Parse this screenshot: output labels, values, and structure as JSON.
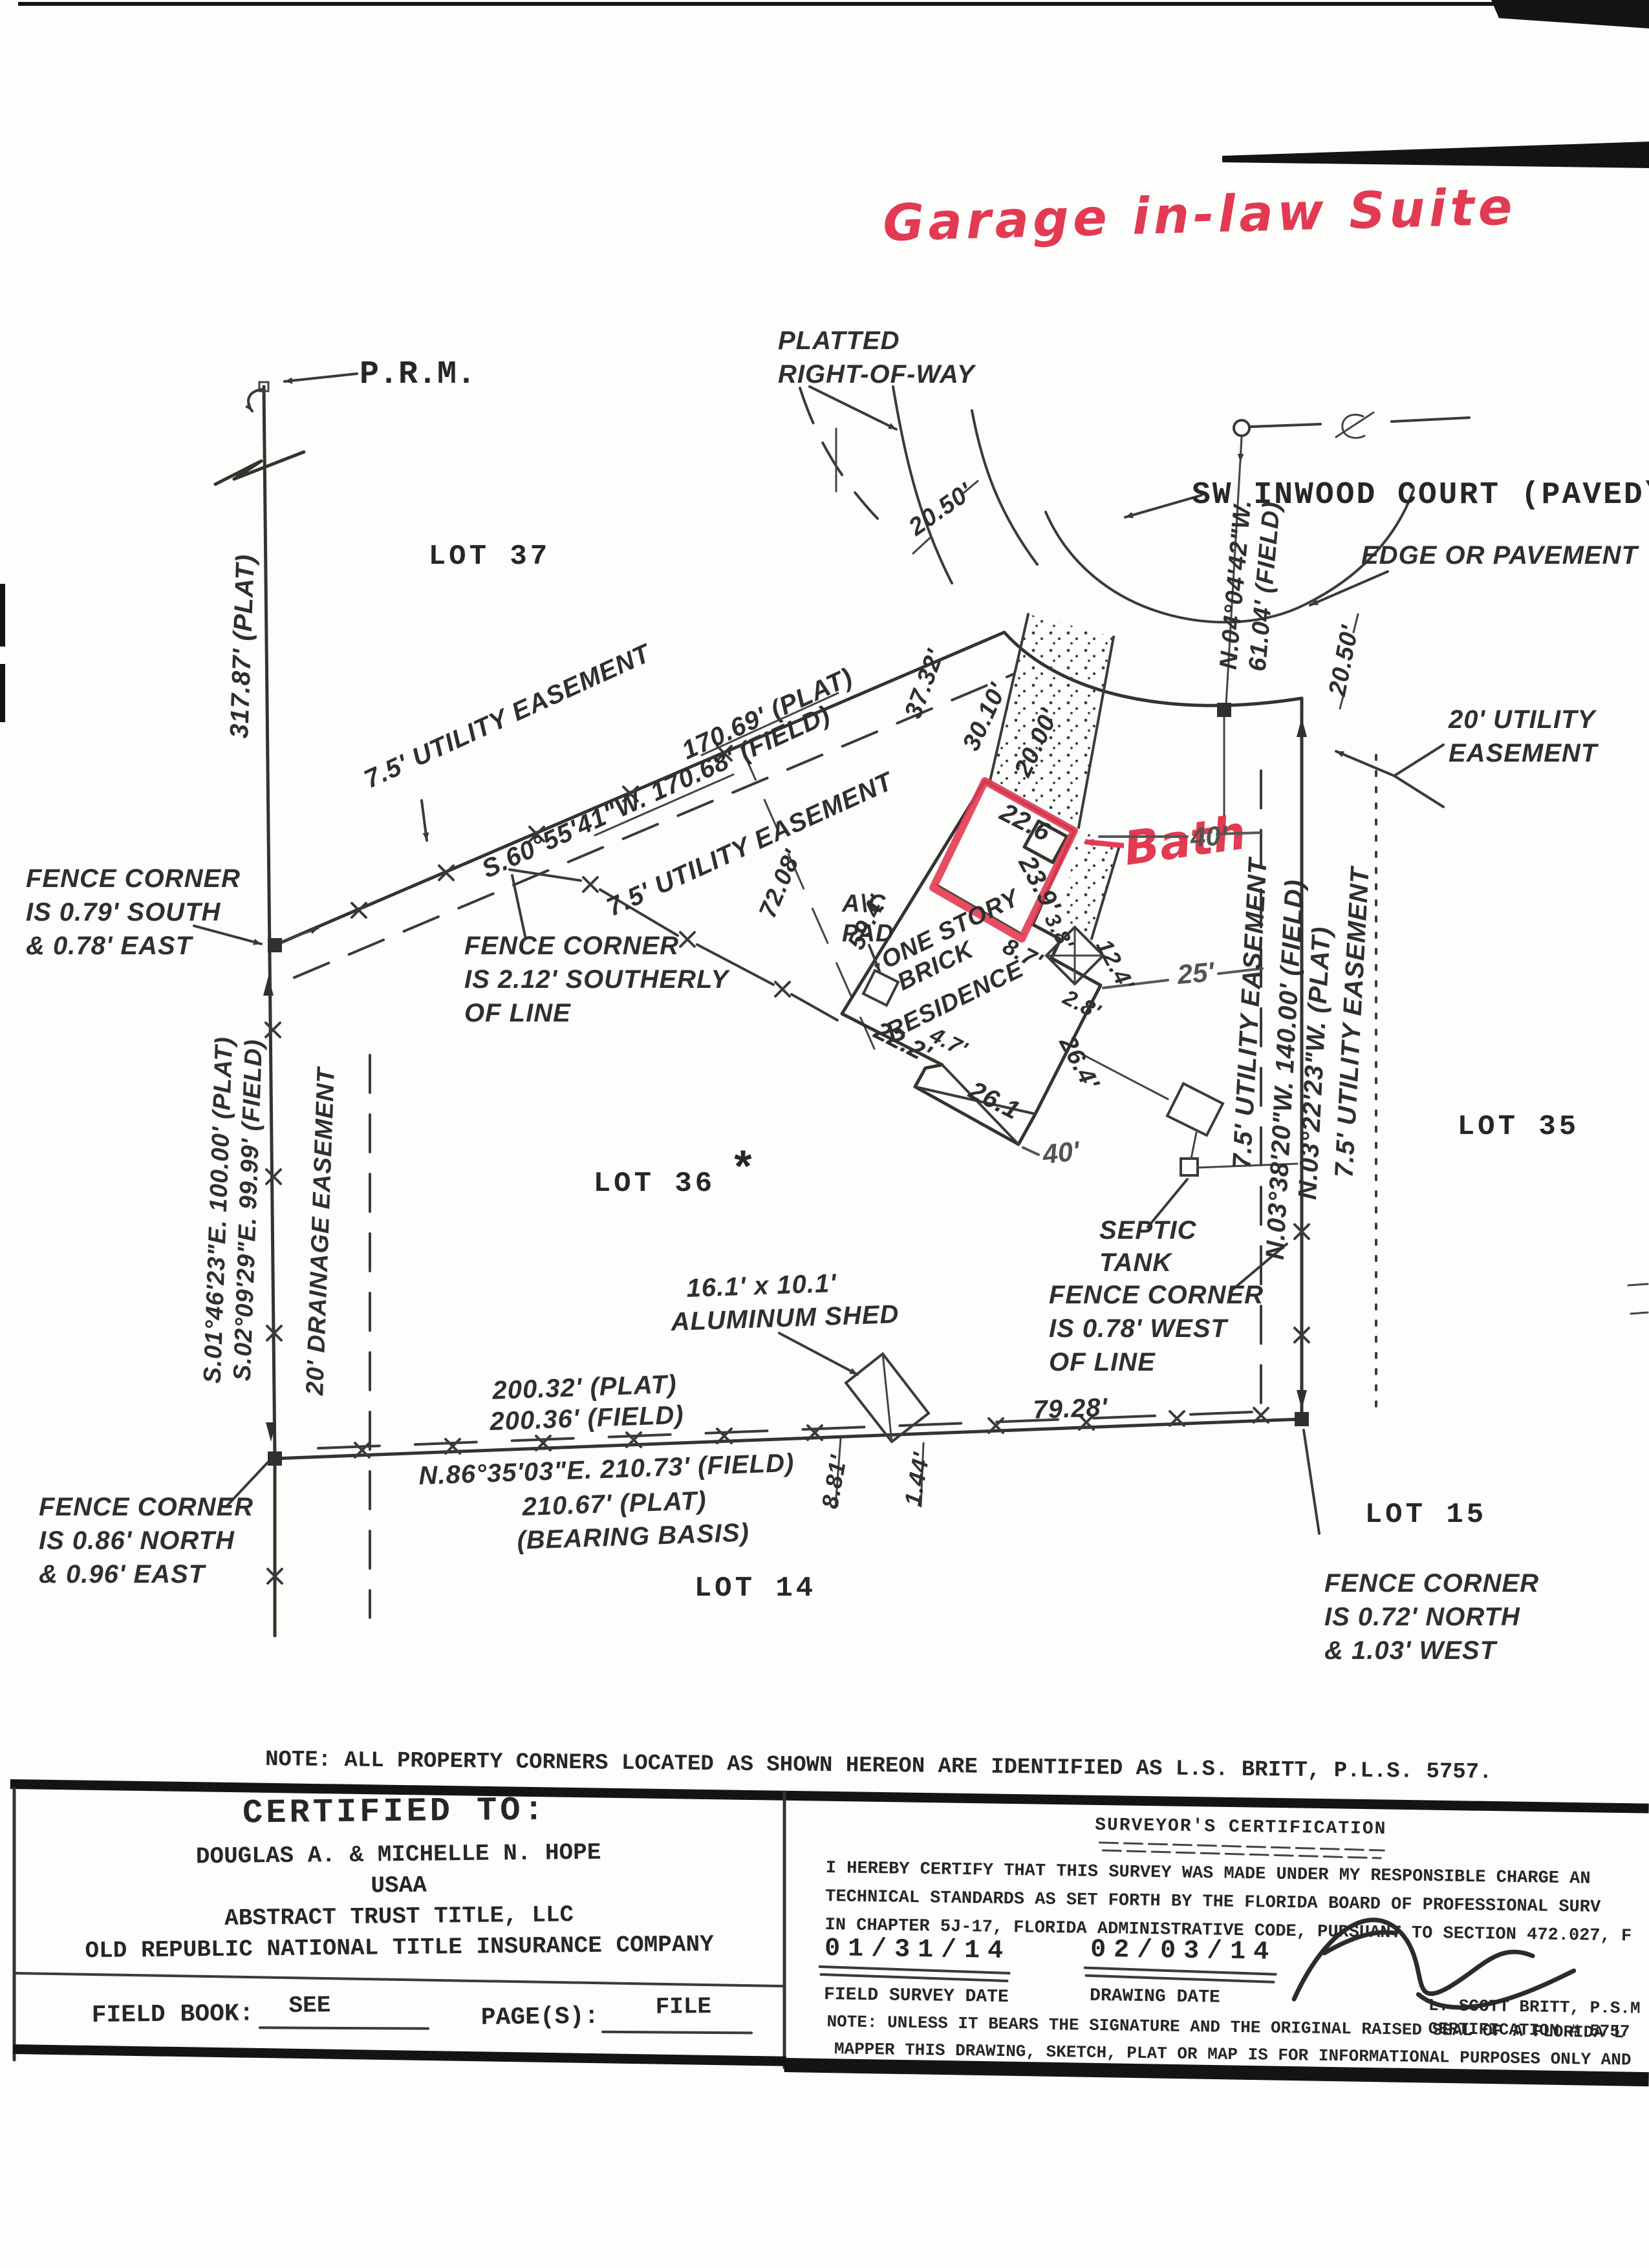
{
  "colors": {
    "marker_red": "#e23a52",
    "ink": "#2f2f2d",
    "pencil": "#525250"
  },
  "annotations": {
    "title": "Garage in-law Suite",
    "bath": "Bath"
  },
  "header": {
    "prm": "P.R.M.",
    "platted_row_1": "PLATTED",
    "platted_row_2": "RIGHT-OF-WAY",
    "street": "SW INWOOD COURT (PAVED\\PU",
    "edge_of_pavement": "EDGE OR PAVEMENT",
    "court_bearing": "N.04°04'42\"W.",
    "court_distance": "61.04' (FIELD)"
  },
  "lots": {
    "lot37": "LOT 37",
    "lot36": "LOT 36",
    "lot35": "LOT 35",
    "lot15": "LOT 15",
    "lot14": "LOT 14"
  },
  "misc": {
    "asterisk": "*"
  },
  "west": {
    "plat_317": "317.87' (PLAT)",
    "bearing_plat": "S.01°46'23\"E.  100.00' (PLAT)",
    "bearing_field": "S.02°09'29\"E.  99.99' (FIELD)",
    "drainage": "20' DRAINAGE EASEMENT"
  },
  "northeast": {
    "easement_a": "7.5' UTILITY EASEMENT",
    "plat": "170.69' (PLAT)",
    "field": "S.60°55'41\"W.  170.68' (FIELD)",
    "easement_b": "7.5' UTILITY EASEMENT",
    "tie": "72.08'"
  },
  "court_dims": {
    "d2050a": "20.50'",
    "d2050b": "20.50'",
    "d3732": "37.32'",
    "d3010": "30.10'",
    "d2000": "20.00'",
    "util20_1": "20' UTILITY",
    "util20_2": "EASEMENT"
  },
  "east": {
    "easement_w": "7.5' UTILITY EASEMENT",
    "field": "N.03°38'20\"W.  140.00' (FIELD)",
    "plat": "N.03°22'23\"W.  (PLAT)",
    "easement_e": "7.5' UTILITY EASEMENT"
  },
  "south": {
    "plat": "200.32' (PLAT)",
    "field": "200.36' (FIELD)",
    "d7928": "79.28'",
    "bearing": "N.86°35'03\"E.  210.73' (FIELD)",
    "plat2": "210.67' (PLAT)",
    "basis": "(BEARING BASIS)",
    "d881": "8.81'",
    "d144": "1.44'"
  },
  "house": {
    "l1": "ONE STORY",
    "l2": "BRICK",
    "l3": "RESIDENCE",
    "ac1": "A\\C",
    "ac2": "PAD",
    "d594": "59.4'",
    "d226": "22.6",
    "d239": "23.9'",
    "d87": "8.7'",
    "d38": "3.8'",
    "d124": "12.4'",
    "d28": "2.8'",
    "d264": "26.4'",
    "d222": "22.2'",
    "d47": "4.7'",
    "d261": "26.1"
  },
  "pencil": {
    "p25": "25'",
    "p40a": "40'",
    "p40b": "40'"
  },
  "septic": {
    "l1": "SEPTIC",
    "l2": "TANK"
  },
  "shed": {
    "l1": "16.1' x 10.1'",
    "l2": "ALUMINUM SHED"
  },
  "fence_notes": {
    "nw1": "FENCE CORNER",
    "nw2": "IS 0.79' SOUTH",
    "nw3": "& 0.78' EAST",
    "mid1": "FENCE CORNER",
    "mid2": "IS 2.12' SOUTHERLY",
    "mid3": "OF LINE",
    "e1": "FENCE CORNER",
    "e2": "IS 0.78' WEST",
    "e3": "OF LINE",
    "sw1": "FENCE CORNER",
    "sw2": "IS 0.86' NORTH",
    "sw3": "& 0.96' EAST",
    "se1": "FENCE CORNER",
    "se2": "IS 0.72' NORTH",
    "se3": "& 1.03' WEST"
  },
  "note": "NOTE: ALL PROPERTY CORNERS LOCATED AS SHOWN HEREON ARE IDENTIFIED AS L.S. BRITT, P.L.S. 5757.",
  "certified": {
    "heading": "CERTIFIED TO:",
    "name1": "DOUGLAS A. & MICHELLE N. HOPE",
    "name2": "USAA",
    "name3": "ABSTRACT TRUST TITLE, LLC",
    "name4": "OLD REPUBLIC NATIONAL TITLE INSURANCE COMPANY",
    "field_book_label": "FIELD BOOK:",
    "field_book_value": "SEE",
    "pages_label": "PAGE(S):",
    "pages_value": "FILE"
  },
  "certification": {
    "heading": "SURVEYOR'S CERTIFICATION",
    "body1": "I HEREBY CERTIFY THAT THIS SURVEY WAS MADE UNDER MY RESPONSIBLE CHARGE AN",
    "body2": "TECHNICAL STANDARDS AS SET FORTH BY THE FLORIDA BOARD OF PROFESSIONAL SURV",
    "body3": "IN CHAPTER 5J-17, FLORIDA ADMINISTRATIVE CODE, PURSUANT TO SECTION 472.027, F",
    "field_date": "01/31/14",
    "field_date_label": "FIELD SURVEY DATE",
    "drawing_date": "02/03/14",
    "drawing_date_label": "DRAWING DATE",
    "surveyor": "L. SCOTT BRITT, P.S.M",
    "cert_no": "CERTIFICATION # 5757",
    "note1": "NOTE: UNLESS IT BEARS THE SIGNATURE AND THE ORIGINAL RAISED SEAL OF A FLORIDA L",
    "note2": "MAPPER THIS DRAWING, SKETCH, PLAT OR MAP IS FOR INFORMATIONAL PURPOSES ONLY AND"
  }
}
